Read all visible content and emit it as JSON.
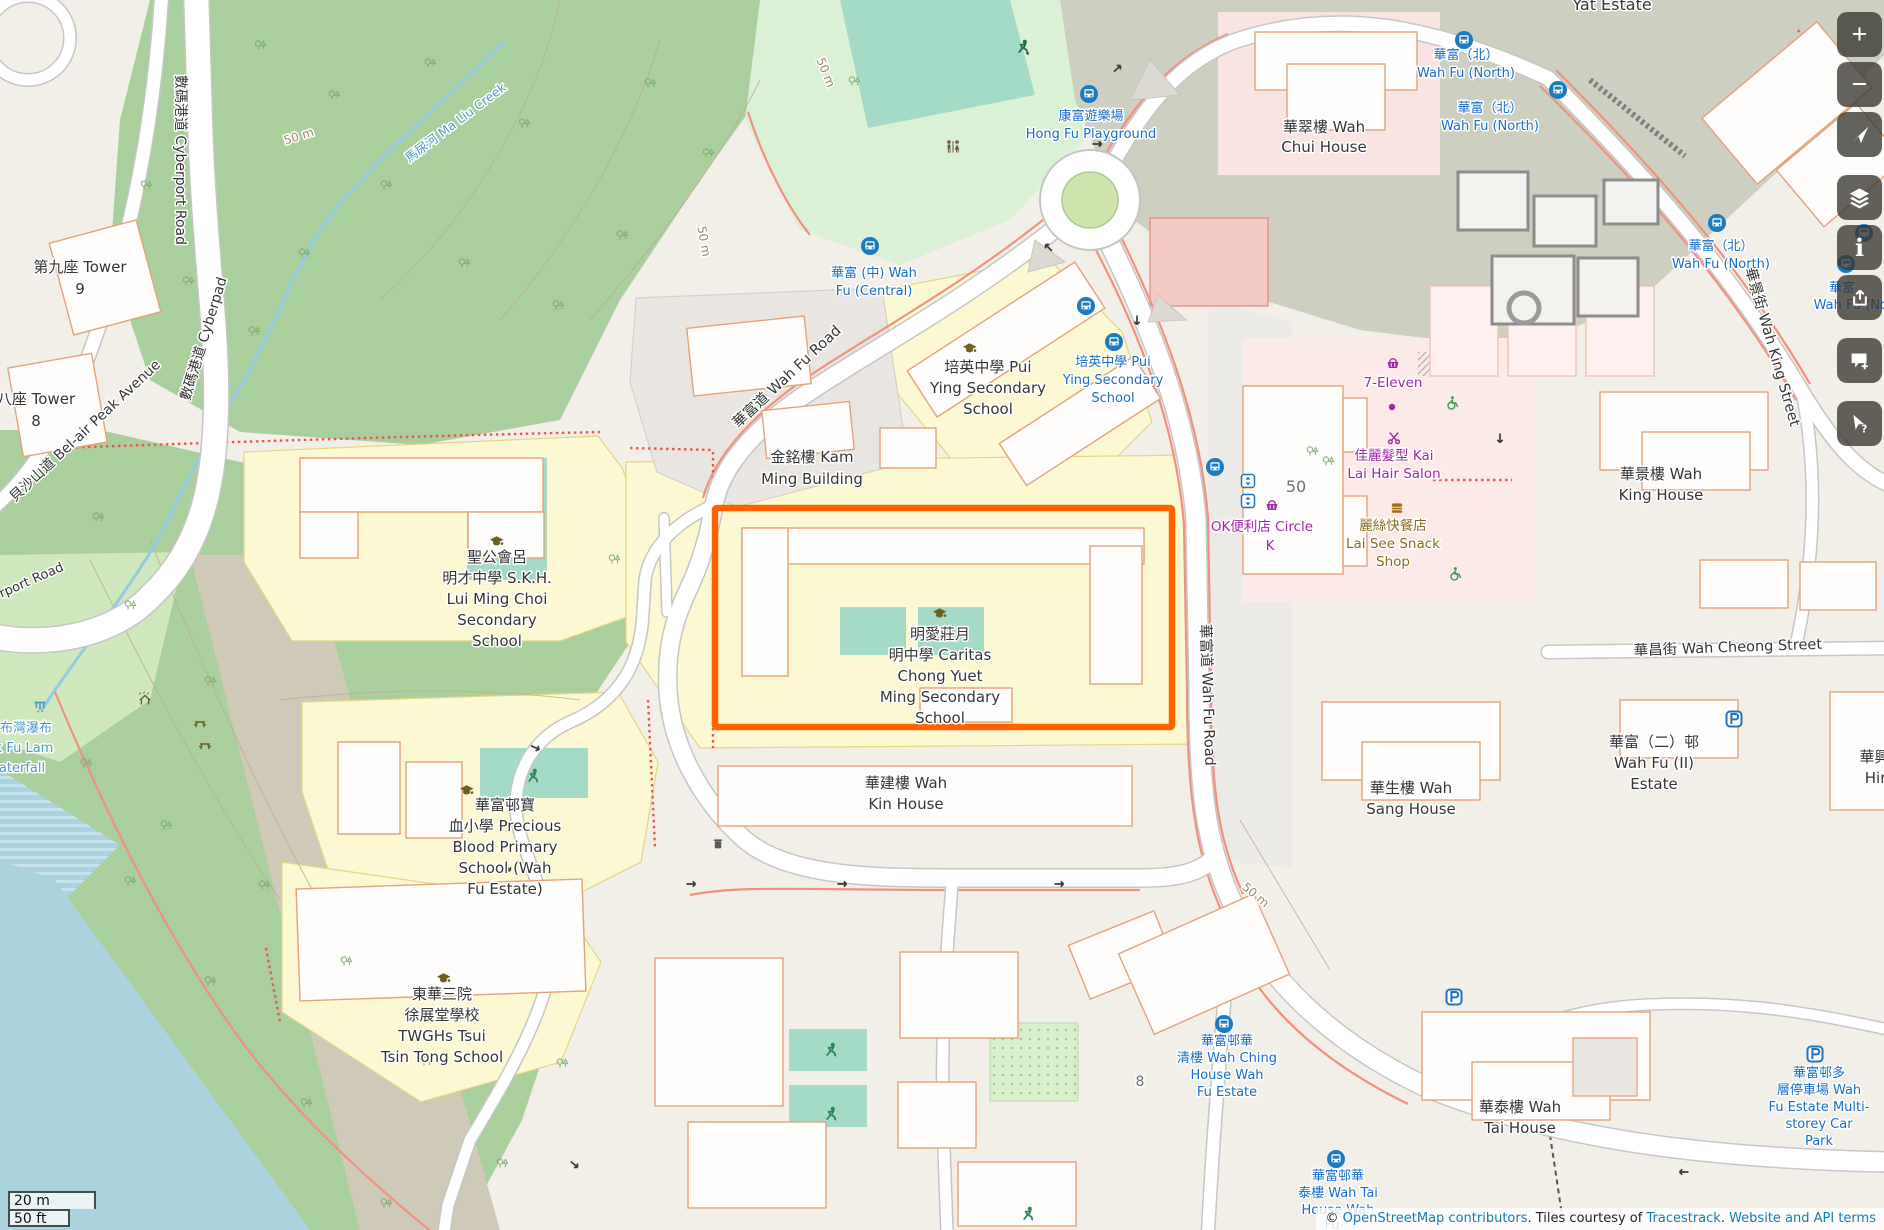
{
  "map": {
    "highlight": {
      "x": 715,
      "y": 508,
      "w": 457,
      "h": 219,
      "color": "#ff6200"
    },
    "palette": {
      "poi": "#363636",
      "bus": "#1a6ec6",
      "shop": "#a128a8",
      "food": "#8a6d1e",
      "water": "#4d9bc6",
      "contour": "#9c8a66",
      "gray": "#6f6f6f"
    },
    "labels": [
      {
        "t": "Yat Estate",
        "x": 1612,
        "y": 10,
        "s": 16
      },
      {
        "t": "華翠樓 Wah",
        "x": 1324,
        "y": 132
      },
      {
        "t": "Chui House",
        "x": 1324,
        "y": 152
      },
      {
        "t": "第九座 Tower",
        "x": 80,
        "y": 272
      },
      {
        "t": "9",
        "x": 80,
        "y": 294
      },
      {
        "t": "八座 Tower",
        "x": 36,
        "y": 404
      },
      {
        "t": "8",
        "x": 36,
        "y": 426
      },
      {
        "t": "數碼港道 Cyberport Road",
        "x": 176,
        "y": 160,
        "r": 90,
        "s": 14
      },
      {
        "t": "數碼港道 Cyberpad",
        "x": 208,
        "y": 340,
        "r": -73,
        "s": 14
      },
      {
        "t": "貝沙山道 Bel-air Peak Avenue",
        "x": 88,
        "y": 434,
        "r": -43,
        "s": 14
      },
      {
        "t": "rport Road",
        "x": 33,
        "y": 584,
        "r": -24,
        "s": 13
      },
      {
        "t": "馬尿河 Ma Liu Creek",
        "x": 458,
        "y": 126,
        "r": -37,
        "s": 12.5,
        "c": "water"
      },
      {
        "t": "50 m",
        "x": 300,
        "y": 140,
        "r": -18,
        "s": 12,
        "c": "contour"
      },
      {
        "t": "50 m",
        "x": 822,
        "y": 74,
        "r": 68,
        "s": 12,
        "c": "contour"
      },
      {
        "t": "50 m",
        "x": 700,
        "y": 242,
        "r": 80,
        "s": 12,
        "c": "contour"
      },
      {
        "t": "50 m",
        "x": 1253,
        "y": 898,
        "r": 40,
        "s": 12,
        "c": "contour"
      },
      {
        "t": "華富道 Wah Fu Road",
        "x": 790,
        "y": 380,
        "r": -43,
        "s": 14.5
      },
      {
        "t": "華富道 Wah Fu Road",
        "x": 1203,
        "y": 695,
        "r": 88,
        "s": 14.5
      },
      {
        "t": "華景街 Wah King Street",
        "x": 1768,
        "y": 348,
        "r": 74,
        "s": 14.5
      },
      {
        "t": "華昌街 Wah Cheong Street",
        "x": 1728,
        "y": 652,
        "r": -2,
        "s": 14.5
      },
      {
        "t": "金銘樓 Kam",
        "x": 812,
        "y": 462
      },
      {
        "t": "Ming Building",
        "x": 812,
        "y": 484
      },
      {
        "t": "培英中學 Pui",
        "x": 988,
        "y": 372
      },
      {
        "t": "Ying Secondary",
        "x": 988,
        "y": 393
      },
      {
        "t": "School",
        "x": 988,
        "y": 414
      },
      {
        "t": "聖公會呂",
        "x": 497,
        "y": 562
      },
      {
        "t": "明才中學 S.K.H.",
        "x": 497,
        "y": 583
      },
      {
        "t": "Lui Ming Choi",
        "x": 497,
        "y": 604
      },
      {
        "t": "Secondary",
        "x": 497,
        "y": 625
      },
      {
        "t": "School",
        "x": 497,
        "y": 646
      },
      {
        "t": "明愛莊月",
        "x": 940,
        "y": 639
      },
      {
        "t": "明中學 Caritas",
        "x": 940,
        "y": 660
      },
      {
        "t": "Chong Yuet",
        "x": 940,
        "y": 681
      },
      {
        "t": "Ming Secondary",
        "x": 940,
        "y": 702
      },
      {
        "t": "School",
        "x": 940,
        "y": 723
      },
      {
        "t": "華富邨寶",
        "x": 505,
        "y": 810
      },
      {
        "t": "血小學 Precious",
        "x": 505,
        "y": 831
      },
      {
        "t": "Blood Primary",
        "x": 505,
        "y": 852
      },
      {
        "t": "School (Wah",
        "x": 505,
        "y": 873
      },
      {
        "t": "Fu Estate)",
        "x": 505,
        "y": 894
      },
      {
        "t": "東華三院",
        "x": 442,
        "y": 999
      },
      {
        "t": "徐展堂學校",
        "x": 442,
        "y": 1020
      },
      {
        "t": "TWGHs Tsui",
        "x": 442,
        "y": 1041
      },
      {
        "t": "Tsin Tong School",
        "x": 442,
        "y": 1062
      },
      {
        "t": "華建樓 Wah",
        "x": 906,
        "y": 788
      },
      {
        "t": "Kin House",
        "x": 906,
        "y": 809
      },
      {
        "t": "華生樓 Wah",
        "x": 1411,
        "y": 793
      },
      {
        "t": "Sang House",
        "x": 1411,
        "y": 814
      },
      {
        "t": "華景樓 Wah",
        "x": 1661,
        "y": 479
      },
      {
        "t": "King House",
        "x": 1661,
        "y": 500
      },
      {
        "t": "華富（二）邨",
        "x": 1654,
        "y": 747
      },
      {
        "t": "Wah Fu (II)",
        "x": 1654,
        "y": 768
      },
      {
        "t": "Estate",
        "x": 1654,
        "y": 789
      },
      {
        "t": "華興樓",
        "x": 1882,
        "y": 762
      },
      {
        "t": "Hing",
        "x": 1882,
        "y": 783
      },
      {
        "t": "華泰樓 Wah",
        "x": 1520,
        "y": 1112
      },
      {
        "t": "Tai House",
        "x": 1520,
        "y": 1133
      },
      {
        "t": "8",
        "x": 1140,
        "y": 1086,
        "s": 14,
        "c": "gray"
      },
      {
        "t": "50",
        "x": 1296,
        "y": 492,
        "s": 16,
        "c": "gray"
      },
      {
        "t": "華富 (中) Wah",
        "x": 874,
        "y": 277,
        "s": 13,
        "c": "bus"
      },
      {
        "t": "Fu (Central)",
        "x": 874,
        "y": 295,
        "s": 13,
        "c": "bus"
      },
      {
        "t": "康富遊樂場",
        "x": 1091,
        "y": 120,
        "s": 13,
        "c": "bus"
      },
      {
        "t": "Hong Fu Playground",
        "x": 1091,
        "y": 138,
        "s": 13,
        "c": "bus"
      },
      {
        "t": "培英中學 Pui",
        "x": 1113,
        "y": 366,
        "s": 13,
        "c": "bus"
      },
      {
        "t": "Ying Secondary",
        "x": 1113,
        "y": 384,
        "s": 13,
        "c": "bus"
      },
      {
        "t": "School",
        "x": 1113,
        "y": 402,
        "s": 13,
        "c": "bus"
      },
      {
        "t": "華富（北）",
        "x": 1466,
        "y": 59,
        "s": 13,
        "c": "bus"
      },
      {
        "t": "Wah Fu (North)",
        "x": 1466,
        "y": 77,
        "s": 13,
        "c": "bus"
      },
      {
        "t": "華富（北）",
        "x": 1490,
        "y": 112,
        "s": 13,
        "c": "bus"
      },
      {
        "t": "Wah Fu (North)",
        "x": 1490,
        "y": 130,
        "s": 13,
        "c": "bus"
      },
      {
        "t": "華富（北）",
        "x": 1721,
        "y": 250,
        "s": 13,
        "c": "bus"
      },
      {
        "t": "Wah Fu (North)",
        "x": 1721,
        "y": 268,
        "s": 13,
        "c": "bus"
      },
      {
        "t": "華富",
        "x": 1842,
        "y": 292,
        "s": 13,
        "c": "bus"
      },
      {
        "t": "Wah Fu (Nort",
        "x": 1856,
        "y": 309,
        "s": 13,
        "c": "bus"
      },
      {
        "t": "華富邨華",
        "x": 1227,
        "y": 1045,
        "s": 13,
        "c": "bus"
      },
      {
        "t": "清樓 Wah Ching",
        "x": 1227,
        "y": 1062,
        "s": 13,
        "c": "bus"
      },
      {
        "t": "House Wah",
        "x": 1227,
        "y": 1079,
        "s": 13,
        "c": "bus"
      },
      {
        "t": "Fu Estate",
        "x": 1227,
        "y": 1096,
        "s": 13,
        "c": "bus"
      },
      {
        "t": "華富邨華",
        "x": 1338,
        "y": 1180,
        "s": 13,
        "c": "bus"
      },
      {
        "t": "泰樓 Wah Tai",
        "x": 1338,
        "y": 1197,
        "s": 13,
        "c": "bus"
      },
      {
        "t": "House Wah",
        "x": 1338,
        "y": 1214,
        "s": 13,
        "c": "bus"
      },
      {
        "t": "Fu",
        "x": 1332,
        "y": 1229,
        "s": 13,
        "c": "bus"
      },
      {
        "t": "華富邨多",
        "x": 1819,
        "y": 1077,
        "s": 13,
        "c": "bus"
      },
      {
        "t": "層停車場 Wah",
        "x": 1819,
        "y": 1094,
        "s": 13,
        "c": "bus"
      },
      {
        "t": "Fu Estate Multi-",
        "x": 1819,
        "y": 1111,
        "s": 13,
        "c": "bus"
      },
      {
        "t": "storey Car",
        "x": 1819,
        "y": 1128,
        "s": 13,
        "c": "bus"
      },
      {
        "t": "Park",
        "x": 1819,
        "y": 1145,
        "s": 13,
        "c": "bus"
      },
      {
        "t": "布灣瀑布",
        "x": 26,
        "y": 732,
        "s": 13,
        "c": "water"
      },
      {
        "t": "k Fu Lam",
        "x": 24,
        "y": 752,
        "s": 13,
        "c": "water"
      },
      {
        "t": "aterfall",
        "x": 22,
        "y": 772,
        "s": 13,
        "c": "water"
      },
      {
        "t": "7-Eleven",
        "x": 1393,
        "y": 387,
        "s": 13.5,
        "c": "shop"
      },
      {
        "t": "佳麗髮型 Kai",
        "x": 1394,
        "y": 460,
        "s": 13.5,
        "c": "shop"
      },
      {
        "t": "Lai Hair Salon",
        "x": 1394,
        "y": 478,
        "s": 13.5,
        "c": "shop"
      },
      {
        "t": "OK便利店 Circle",
        "x": 1262,
        "y": 531,
        "s": 13.5,
        "c": "shop"
      },
      {
        "t": "K",
        "x": 1270,
        "y": 550,
        "s": 13.5,
        "c": "shop"
      },
      {
        "t": "麗絲快餐店",
        "x": 1393,
        "y": 530,
        "s": 13.5,
        "c": "food"
      },
      {
        "t": "Lai See Snack",
        "x": 1393,
        "y": 548,
        "s": 13.5,
        "c": "food"
      },
      {
        "t": "Shop",
        "x": 1393,
        "y": 566,
        "s": 13.5,
        "c": "food"
      }
    ],
    "icons": [
      {
        "k": "bus",
        "x": 870,
        "y": 246
      },
      {
        "k": "bus",
        "x": 1089,
        "y": 94
      },
      {
        "k": "bus",
        "x": 1464,
        "y": 40
      },
      {
        "k": "bus",
        "x": 1558,
        "y": 90
      },
      {
        "k": "bus",
        "x": 1717,
        "y": 223
      },
      {
        "k": "bus",
        "x": 1864,
        "y": 233
      },
      {
        "k": "bus",
        "x": 1846,
        "y": 264
      },
      {
        "k": "bus",
        "x": 1086,
        "y": 306
      },
      {
        "k": "bus",
        "x": 1114,
        "y": 342
      },
      {
        "k": "bus",
        "x": 1215,
        "y": 467
      },
      {
        "k": "bus",
        "x": 1224,
        "y": 1024
      },
      {
        "k": "bus",
        "x": 1336,
        "y": 1159
      },
      {
        "k": "school",
        "x": 970,
        "y": 348
      },
      {
        "k": "school",
        "x": 497,
        "y": 541
      },
      {
        "k": "school",
        "x": 940,
        "y": 613
      },
      {
        "k": "school",
        "x": 467,
        "y": 790
      },
      {
        "k": "school",
        "x": 444,
        "y": 978
      },
      {
        "k": "toilets",
        "x": 953,
        "y": 147
      },
      {
        "k": "soccer",
        "x": 1023,
        "y": 47
      },
      {
        "k": "runner",
        "x": 533,
        "y": 776
      },
      {
        "k": "runner",
        "x": 831,
        "y": 1050
      },
      {
        "k": "runner",
        "x": 831,
        "y": 1114
      },
      {
        "k": "runner",
        "x": 1028,
        "y": 1214
      },
      {
        "k": "basket",
        "x": 1393,
        "y": 364
      },
      {
        "k": "basket",
        "x": 1272,
        "y": 506
      },
      {
        "k": "dot",
        "x": 1392,
        "y": 407
      },
      {
        "k": "scissors",
        "x": 1394,
        "y": 438
      },
      {
        "k": "burger",
        "x": 1397,
        "y": 508
      },
      {
        "k": "elevator",
        "x": 1248,
        "y": 481
      },
      {
        "k": "elevator",
        "x": 1248,
        "y": 501
      },
      {
        "k": "parking",
        "x": 1454,
        "y": 997
      },
      {
        "k": "parking",
        "x": 1734,
        "y": 719
      },
      {
        "k": "parking",
        "x": 1815,
        "y": 1054
      },
      {
        "k": "wheelchair",
        "x": 1452,
        "y": 403
      },
      {
        "k": "wheelchair",
        "x": 1455,
        "y": 574
      },
      {
        "k": "waterfall",
        "x": 40,
        "y": 707
      },
      {
        "k": "shelter",
        "x": 145,
        "y": 700
      },
      {
        "k": "picnic",
        "x": 200,
        "y": 723
      },
      {
        "k": "picnic",
        "x": 205,
        "y": 745
      },
      {
        "k": "trash",
        "x": 718,
        "y": 844
      }
    ],
    "arrows": [
      {
        "x": 1118,
        "y": 68,
        "r": -42
      },
      {
        "x": 1098,
        "y": 144,
        "r": 0
      },
      {
        "x": 1048,
        "y": 247,
        "r": -135
      },
      {
        "x": 1137,
        "y": 321,
        "r": 90
      },
      {
        "x": 1500,
        "y": 439,
        "r": 90
      },
      {
        "x": 692,
        "y": 884,
        "r": 0
      },
      {
        "x": 843,
        "y": 884,
        "r": 0
      },
      {
        "x": 1060,
        "y": 884,
        "r": 0
      },
      {
        "x": 1683,
        "y": 1172,
        "r": 180
      },
      {
        "x": 536,
        "y": 748,
        "r": 25
      },
      {
        "x": 508,
        "y": 868,
        "r": 60
      },
      {
        "x": 575,
        "y": 1165,
        "r": 40
      }
    ]
  },
  "controls": {
    "buttons": [
      {
        "id": "zoom-in",
        "label": "Zoom In",
        "glyph": "+",
        "gap": false
      },
      {
        "id": "zoom-out",
        "label": "Zoom Out",
        "glyph": "−",
        "gap": false
      },
      {
        "id": "locate",
        "label": "Show My Location",
        "glyph": "",
        "gap": false
      },
      {
        "id": "layers",
        "label": "Layers",
        "glyph": "",
        "gap": true
      },
      {
        "id": "legend",
        "label": "Map Key",
        "glyph": "i",
        "gap": false
      },
      {
        "id": "share",
        "label": "Share",
        "glyph": "",
        "gap": false
      },
      {
        "id": "note",
        "label": "Add a note to the map",
        "glyph": "",
        "gap": true
      },
      {
        "id": "query",
        "label": "Query features",
        "glyph": "?",
        "gap": true
      }
    ]
  },
  "scalebar": {
    "metric": "20 m",
    "imperial": "50 ft"
  },
  "attribution": {
    "copyright": "© ",
    "osm_link": "OpenStreetMap contributors",
    "middle": ". Tiles courtesy of ",
    "tracestrack_link": "Tracestrack",
    "separator": ". ",
    "terms_link": "Website and API terms"
  }
}
